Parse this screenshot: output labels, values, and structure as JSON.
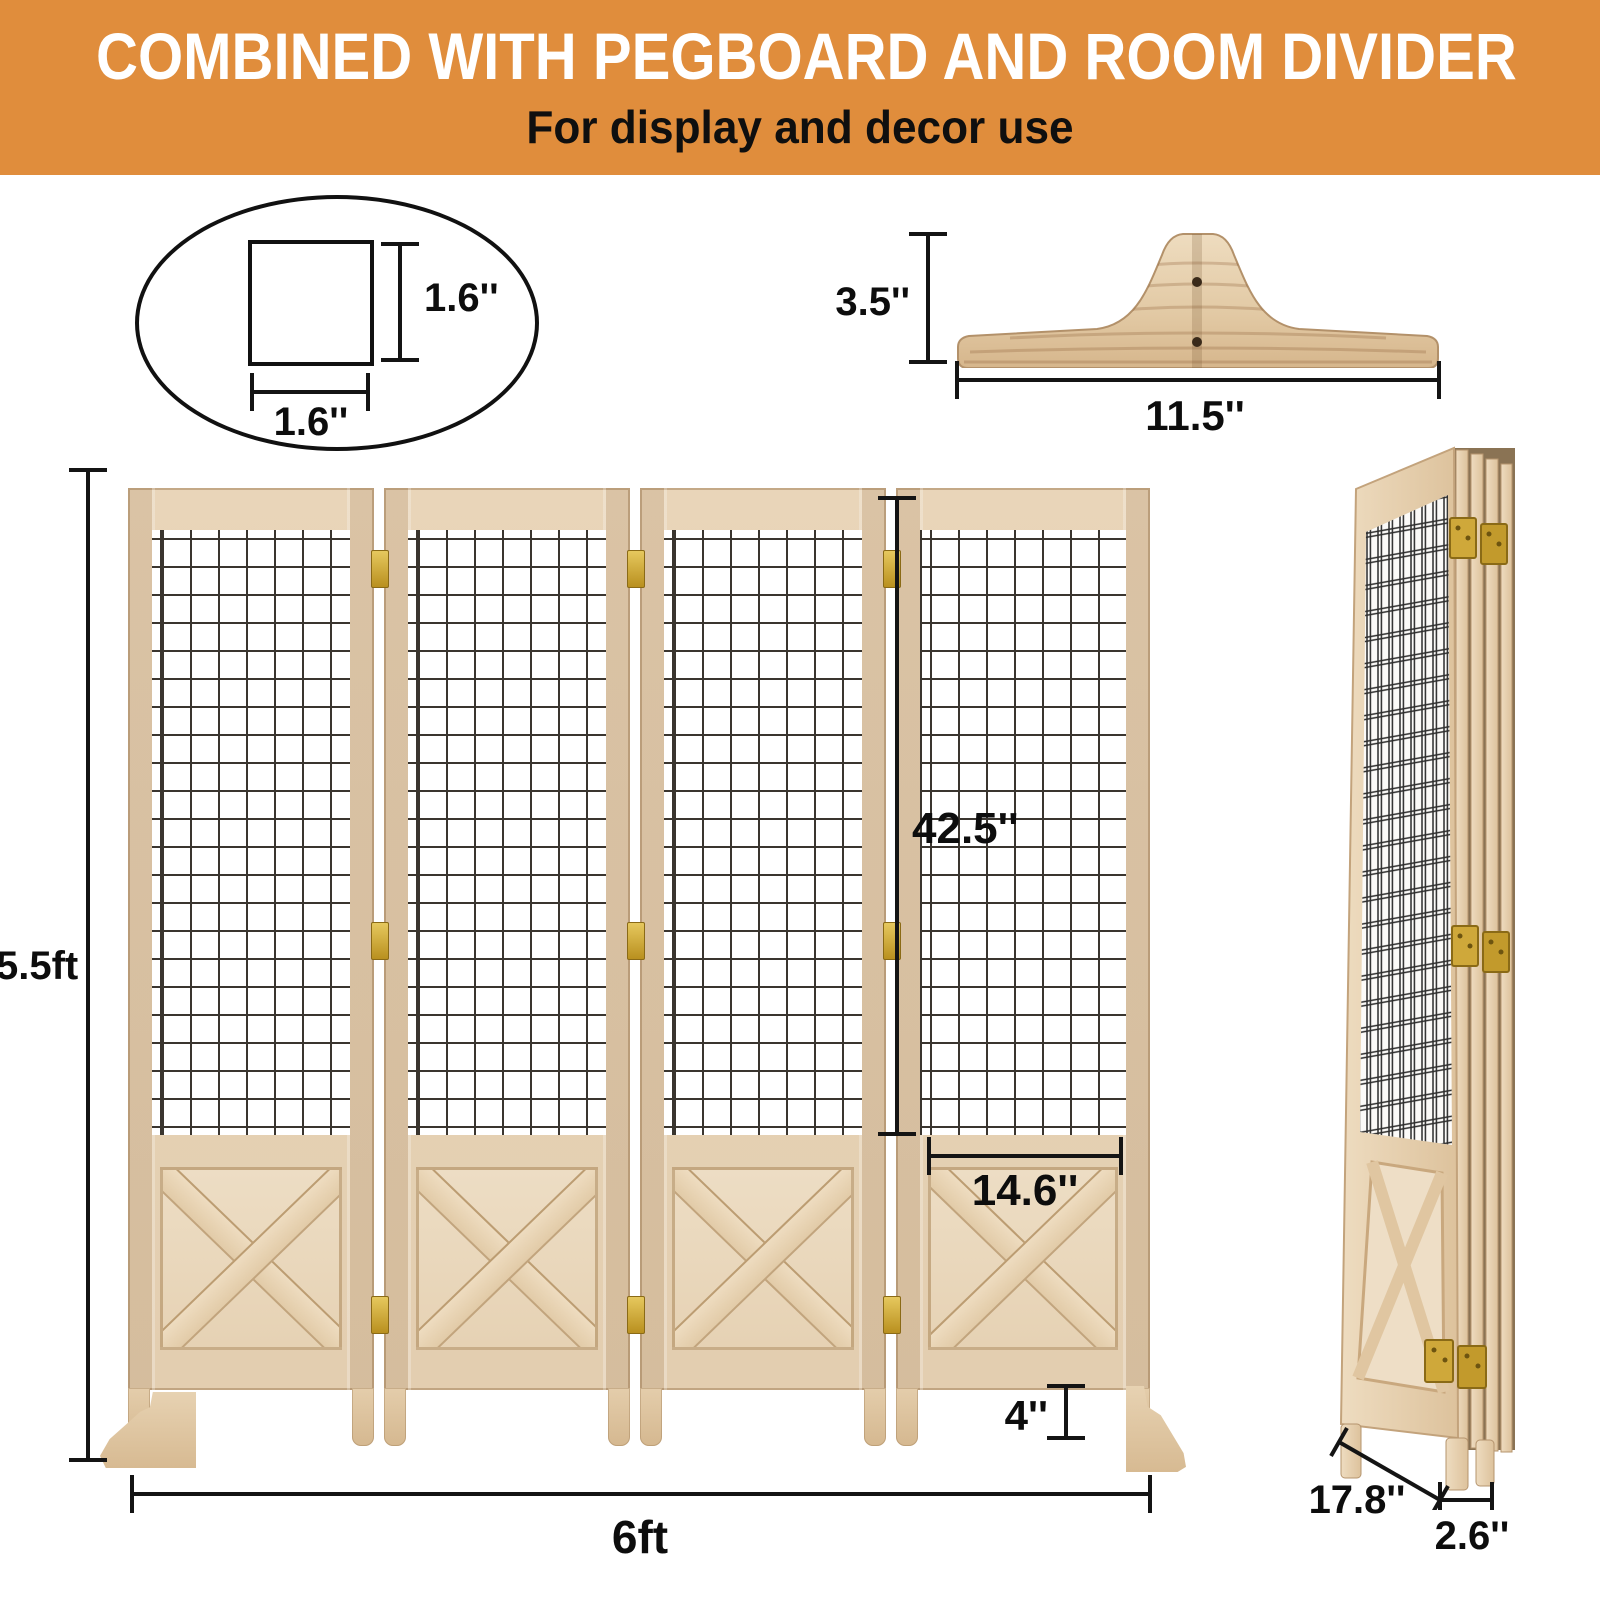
{
  "header": {
    "title": "COMBINED WITH PEGBOARD AND ROOM DIVIDER",
    "subtitle": "For display and decor use"
  },
  "mesh_cell_detail": {
    "width": "1.6''",
    "height": "1.6''"
  },
  "support_foot_detail": {
    "height": "3.5''",
    "width": "11.5''"
  },
  "front_view": {
    "height": "5.5ft",
    "width": "6ft",
    "mesh_height": "42.5''",
    "panel_width": "14.6''",
    "foot_height": "4''"
  },
  "folded_view": {
    "depth": "17.8''",
    "thickness": "2.6''"
  },
  "colors": {
    "header_bg": "#e08d3c",
    "wood_light": "#ecdbc3",
    "wood_mid": "#e0c9a9",
    "wood_dark": "#cdb08b",
    "brass": "#c9a42e",
    "grid_line": "#3a352f",
    "dim_line": "#141414"
  }
}
